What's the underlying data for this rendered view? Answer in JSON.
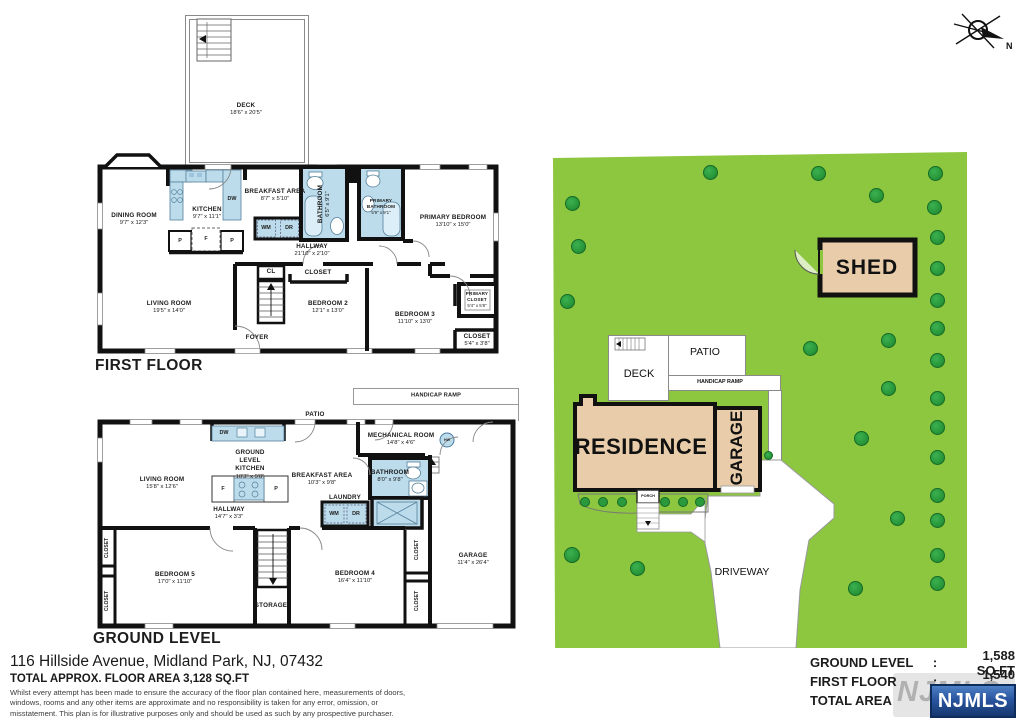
{
  "address": "116 Hillside Avenue, Midland Park, NJ, 07432",
  "total_area_line": "TOTAL APPROX. FLOOR AREA 3,128 SQ.FT",
  "disclaimer": "Whilst every attempt has been made to ensure the accuracy of the floor plan contained here, measurements of doors, windows, rooms and any other items are approximate and no responsibility is taken for any error, omission, or misstatement. This plan is for illustrative purposes only and should be used as such by any prospective purchaser.",
  "north_label": "N",
  "first_floor": {
    "title": "FIRST FLOOR",
    "deck": {
      "name": "DECK",
      "dims": "18'6\" x 20'5\""
    },
    "rooms": {
      "dining": {
        "name": "DINING ROOM",
        "dims": "9'7\" x 12'3\""
      },
      "kitchen": {
        "name": "KITCHEN",
        "dims": "9'7\" x 11'1\""
      },
      "breakfast": {
        "name": "BREAKFAST AREA",
        "dims": "8'7\" x 5'10\""
      },
      "bathroom": {
        "name": "BATHROOM",
        "dims": "6'5\" x 9'1\""
      },
      "primary_bathroom": {
        "name": "PRIMARY BATHROOM",
        "dims": "5'9\" x 9'1\""
      },
      "primary_bedroom": {
        "name": "PRIMARY BEDROOM",
        "dims": "13'10\" x 15'0\""
      },
      "hallway": {
        "name": "HALLWAY",
        "dims": "21'10\" x 2'10\""
      },
      "living": {
        "name": "LIVING ROOM",
        "dims": "19'5\" x 14'0\""
      },
      "foyer": {
        "name": "FOYER"
      },
      "cl": {
        "name": "CL"
      },
      "closet_mid": {
        "name": "CLOSET"
      },
      "bedroom2": {
        "name": "BEDROOM 2",
        "dims": "12'1\" x 13'0\""
      },
      "bedroom3": {
        "name": "BEDROOM 3",
        "dims": "11'10\" x 13'0\""
      },
      "primary_closet": {
        "name": "PRIMARY CLOSET",
        "dims": "5'4\" x 5'8\""
      },
      "closet_br": {
        "name": "CLOSET",
        "dims": "5'4\" x 3'8\""
      }
    },
    "appliances": {
      "dw": "DW",
      "wm": "WM",
      "dr": "DR",
      "p1": "P",
      "f": "F",
      "p2": "P"
    }
  },
  "ground_level": {
    "title": "GROUND LEVEL",
    "outdoor": {
      "patio": "PATIO",
      "handicap_ramp": "HANDICAP RAMP"
    },
    "hw": "HW",
    "rooms": {
      "living": {
        "name": "LIVING ROOM",
        "dims": "15'8\" x 12'6\""
      },
      "kitchen": {
        "name": "GROUND LEVEL KITCHEN",
        "dims": "10'3\" x 9'8\""
      },
      "breakfast": {
        "name": "BREAKFAST AREA",
        "dims": "10'3\" x 9'8\""
      },
      "mechanical": {
        "name": "MECHANICAL ROOM",
        "dims": "14'8\" x 4'6\""
      },
      "bathroom": {
        "name": "BATHROOM",
        "dims": "8'0\" x 9'8\""
      },
      "laundry": {
        "name": "LAUNDRY"
      },
      "hallway": {
        "name": "HALLWAY",
        "dims": "14'7\" x 3'3\""
      },
      "bedroom5": {
        "name": "BEDROOM 5",
        "dims": "17'0\" x 11'10\""
      },
      "storage": {
        "name": "STORAGE"
      },
      "bedroom4": {
        "name": "BEDROOM 4",
        "dims": "16'4\" x 11'10\""
      },
      "garage": {
        "name": "GARAGE",
        "dims": "11'4\" x 26'4\""
      },
      "closet_l1": {
        "name": "CLOSET"
      },
      "closet_l2": {
        "name": "CLOSET"
      },
      "closet_r1": {
        "name": "CLOSET"
      },
      "closet_r2": {
        "name": "CLOSET"
      }
    },
    "appliances": {
      "dw": "DW",
      "wm": "WM",
      "dr": "DR",
      "f": "F",
      "p": "P"
    }
  },
  "site_plan": {
    "labels": {
      "shed": "SHED",
      "residence": "RESIDENCE",
      "garage": "GARAGE",
      "deck": "DECK",
      "patio": "PATIO",
      "handicap_ramp": "HANDICAP RAMP",
      "porch": "PORCH",
      "driveway": "DRIVEWAY"
    },
    "trees": [
      [
        157,
        20,
        15
      ],
      [
        265,
        21,
        15
      ],
      [
        382,
        21,
        15
      ],
      [
        323,
        43,
        15
      ],
      [
        19,
        51,
        15
      ],
      [
        381,
        55,
        15
      ],
      [
        384,
        85,
        15
      ],
      [
        25,
        94,
        15
      ],
      [
        384,
        116,
        15
      ],
      [
        14,
        149,
        15
      ],
      [
        384,
        148,
        15
      ],
      [
        384,
        176,
        15
      ],
      [
        257,
        196,
        15
      ],
      [
        335,
        188,
        15
      ],
      [
        384,
        208,
        15
      ],
      [
        335,
        236,
        15
      ],
      [
        384,
        246,
        15
      ],
      [
        308,
        286,
        15
      ],
      [
        384,
        275,
        15
      ],
      [
        384,
        305,
        15
      ],
      [
        215,
        303,
        9
      ],
      [
        344,
        366,
        15
      ],
      [
        384,
        343,
        15
      ],
      [
        384,
        368,
        15
      ],
      [
        19,
        403,
        16
      ],
      [
        84,
        416,
        15
      ],
      [
        384,
        403,
        15
      ],
      [
        302,
        436,
        15
      ],
      [
        384,
        431,
        15
      ]
    ],
    "bushes": [
      [
        32,
        350
      ],
      [
        50,
        350
      ],
      [
        69,
        350
      ],
      [
        112,
        350
      ],
      [
        130,
        350
      ],
      [
        147,
        350
      ]
    ]
  },
  "summary": {
    "colon": ":",
    "rows": [
      {
        "label": "GROUND LEVEL",
        "value": "1,588 SQ.FT"
      },
      {
        "label": "FIRST FLOOR",
        "value": "1,540 SQ.FT"
      },
      {
        "label": "TOTAL AREA",
        "value": "3,128 SQ.FT"
      }
    ],
    "logo": "NJMLS"
  },
  "colors": {
    "grass": "#8dc63f",
    "tree": "#2a9a3c",
    "building_tan": "#e9cdaa",
    "fixture_blue": "#bcdcec",
    "wall": "#111111",
    "logo_blue": "#16386e"
  }
}
